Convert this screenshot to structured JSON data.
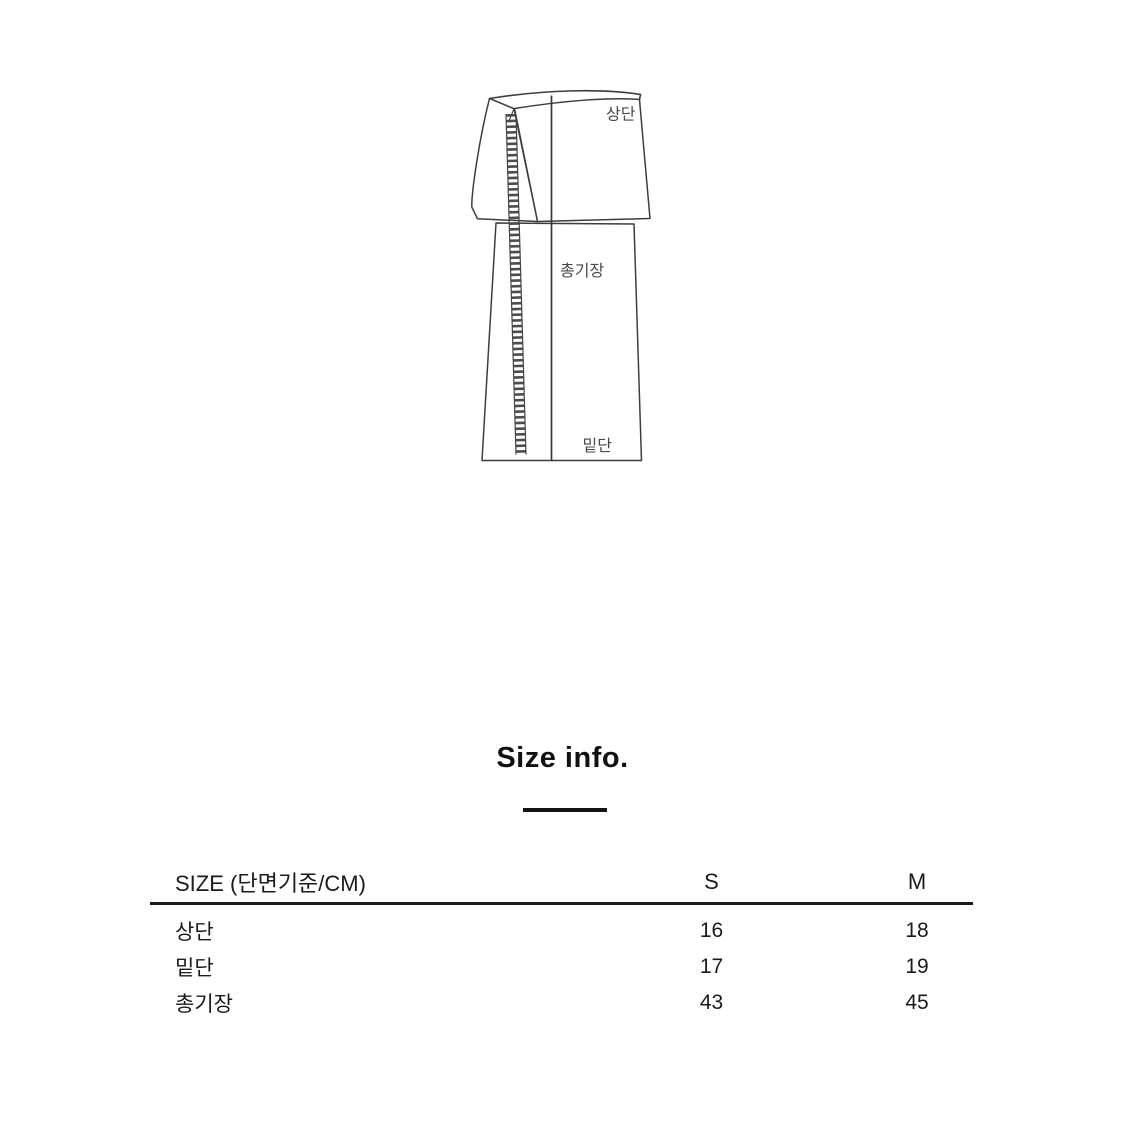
{
  "diagram": {
    "labels": {
      "top_width": "상단",
      "total_length": "총기장",
      "hem_width": "밑단"
    }
  },
  "size_section": {
    "title": "Size info."
  },
  "size_table": {
    "header": {
      "size_label": "SIZE (단면기준/CM)",
      "columns": [
        "S",
        "M"
      ]
    },
    "rows": [
      {
        "label": "상단",
        "values": [
          "16",
          "18"
        ]
      },
      {
        "label": "밑단",
        "values": [
          "17",
          "19"
        ]
      },
      {
        "label": "총기장",
        "values": [
          "43",
          "45"
        ]
      }
    ]
  },
  "colors": {
    "line_art": "#3e3e3e",
    "text": "#1b1b1b",
    "table_rule": "#1c1c1c"
  }
}
